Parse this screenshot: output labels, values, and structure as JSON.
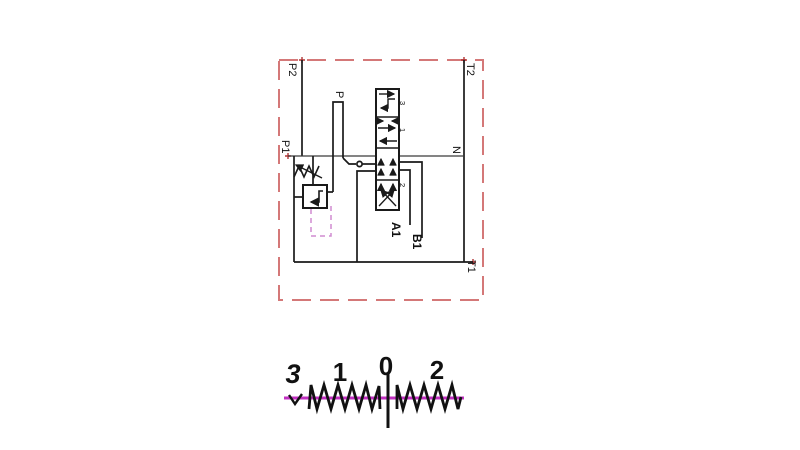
{
  "colors": {
    "line": "#1a1a1a",
    "thin_line": "#3a3a3a",
    "border_red": "#d47878",
    "marker_red": "#b03535",
    "magenta": "#c230c2",
    "pilot_magenta": "#d08cd0"
  },
  "schematic": {
    "ports": {
      "p2": "P2",
      "t2": "T2",
      "p1": "P1",
      "n": "N",
      "t1": "T1",
      "p": "P",
      "a1": "A1",
      "b1": "B1"
    },
    "valve_spool_labels": {
      "top": "3",
      "upper": "1",
      "lower": "2"
    }
  },
  "spool_chart": {
    "positions": [
      "3",
      "1",
      "0",
      "2"
    ]
  }
}
